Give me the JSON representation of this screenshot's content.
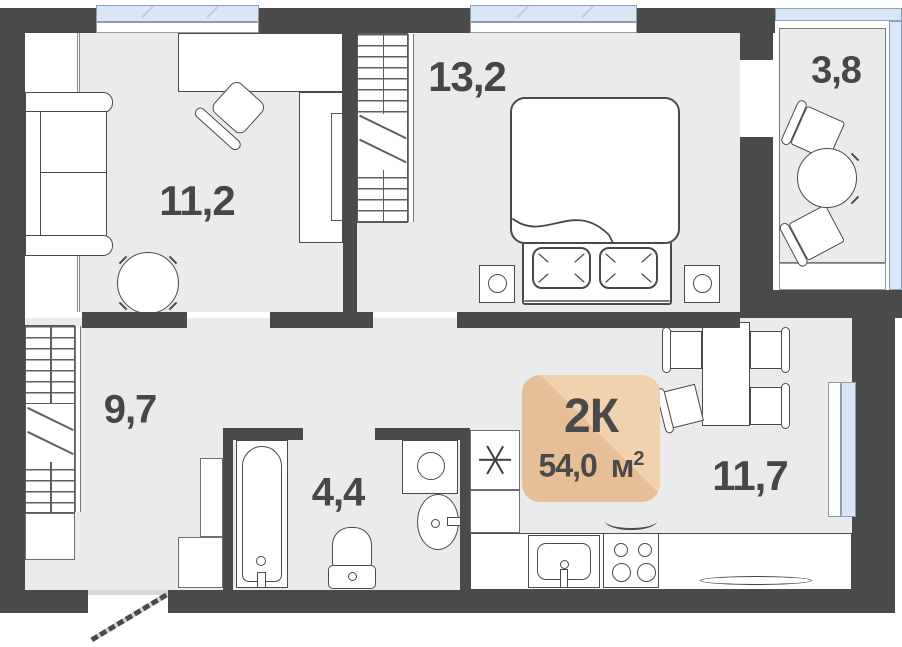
{
  "plan": {
    "badge": {
      "rooms_label": "2К",
      "area_value": "54,0",
      "area_unit": "м",
      "area_sup": "2"
    },
    "rooms": {
      "living": {
        "area_label": "11,2"
      },
      "bedroom": {
        "area_label": "13,2"
      },
      "balcony": {
        "area_label": "3,8"
      },
      "hallway": {
        "area_label": "9,7"
      },
      "bathroom": {
        "area_label": "4,4"
      },
      "kitchen_living": {
        "area_label": "11,7"
      }
    },
    "colors": {
      "wall": "#4a4a4a",
      "floor": "#ebebeb",
      "window_glass": "#d9e6f5",
      "badge": "#e7bf96",
      "badge_highlight": "#f1d2af",
      "text": "#474747"
    },
    "icons": {
      "fridge": "snowflake-asterisk"
    }
  }
}
